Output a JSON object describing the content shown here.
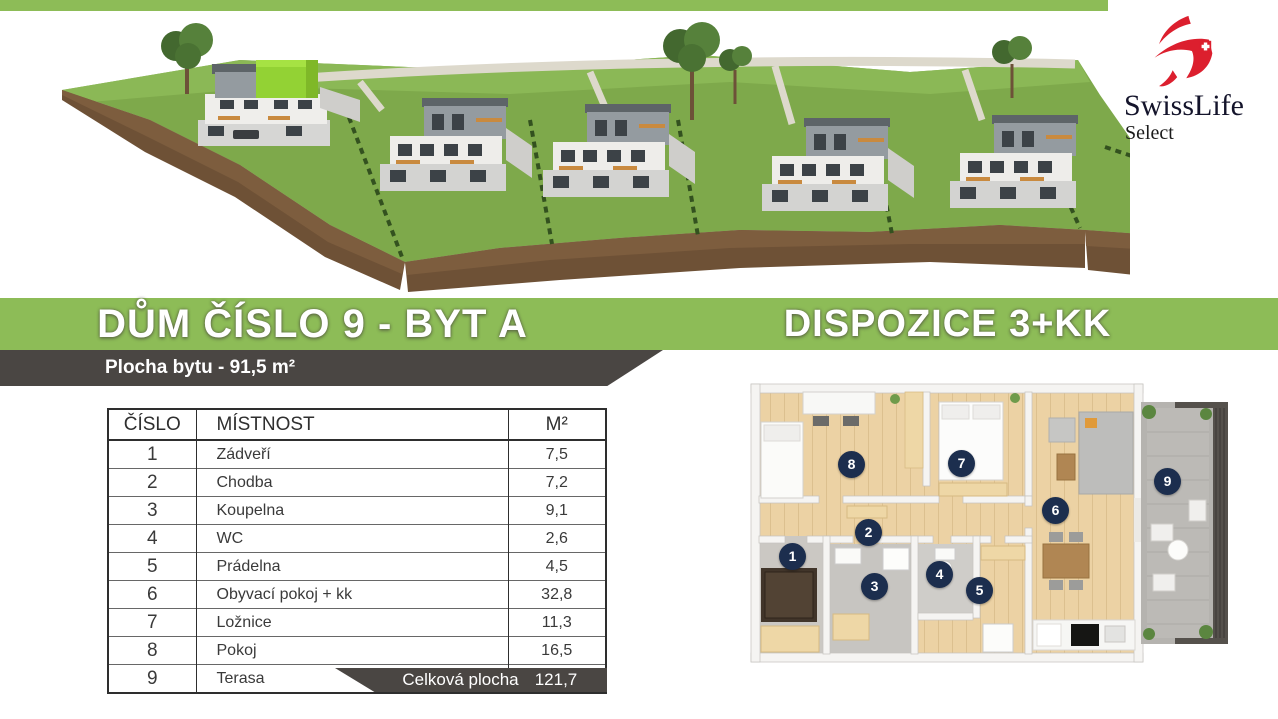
{
  "brand": {
    "name": "SwissLife",
    "sub": "Select"
  },
  "banners": {
    "left_title": "DŮM ČÍSLO 9 - BYT A",
    "right_title": "DISPOZICE 3+KK",
    "area_label": "Plocha bytu - 91,5 m²"
  },
  "table": {
    "headers": [
      "ČÍSLO",
      "MÍSTNOST",
      "M²"
    ],
    "rows": [
      {
        "num": "1",
        "name": "Zádveří",
        "area": "7,5"
      },
      {
        "num": "2",
        "name": "Chodba",
        "area": "7,2"
      },
      {
        "num": "3",
        "name": "Koupelna",
        "area": "9,1"
      },
      {
        "num": "4",
        "name": "WC",
        "area": "2,6"
      },
      {
        "num": "5",
        "name": "Prádelna",
        "area": "4,5"
      },
      {
        "num": "6",
        "name": "Obyvací pokoj + kk",
        "area": "32,8"
      },
      {
        "num": "7",
        "name": "Ložnice",
        "area": "11,3"
      },
      {
        "num": "8",
        "name": "Pokoj",
        "area": "16,5"
      },
      {
        "num": "9",
        "name": "Terasa",
        "area": "30,2"
      }
    ],
    "footer_label": "Celková plocha",
    "footer_value": "121,7"
  },
  "floorplan": {
    "badges": [
      "1",
      "2",
      "3",
      "4",
      "5",
      "6",
      "7",
      "8",
      "9"
    ]
  },
  "colors": {
    "accent_green": "#8dbc57",
    "band_gray": "#4a4643",
    "highlight_unit_green": "#93d234",
    "badge_navy": "#1c2e4e",
    "brand_red": "#dc1f2e"
  }
}
